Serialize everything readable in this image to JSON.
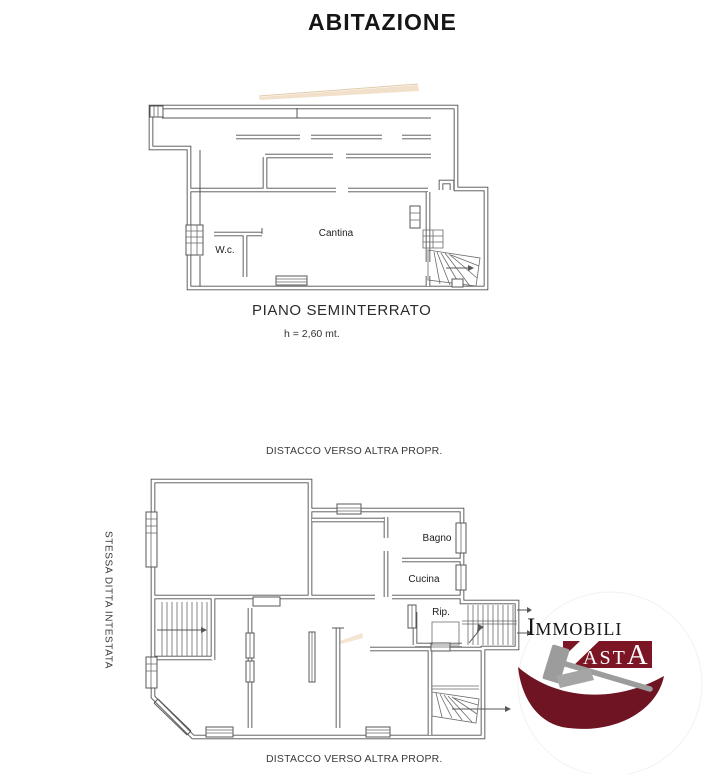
{
  "document": {
    "title": "ABITAZIONE"
  },
  "upper_plan": {
    "caption": "PIANO SEMINTERRATO",
    "height_note": "h = 2,60 mt.",
    "rooms": {
      "cantina": "Cantina",
      "wc": "W.c."
    }
  },
  "lower_plan": {
    "caption_top": "DISTACCO VERSO ALTRA PROPR.",
    "caption_bottom": "DISTACCO VERSO ALTRA PROPR.",
    "caption_left": "STESSA DITTA INTESTATA",
    "rooms": {
      "bagno": "Bagno",
      "cucina": "Cucina",
      "rip": "Rip."
    }
  },
  "logo": {
    "immobili_initial": "I",
    "immobili_rest": "MMOBILI",
    "asta_small": "AST",
    "asta_large": "A",
    "colors": {
      "maroon": "#7c1624",
      "swoosh": "#6e1422",
      "gavel": "#9c9c9c",
      "gavel_block": "#a5a5a5"
    }
  },
  "style": {
    "wall_color": "#4f4f4f",
    "background": "#ffffff",
    "streak": "#f2e0cb"
  }
}
